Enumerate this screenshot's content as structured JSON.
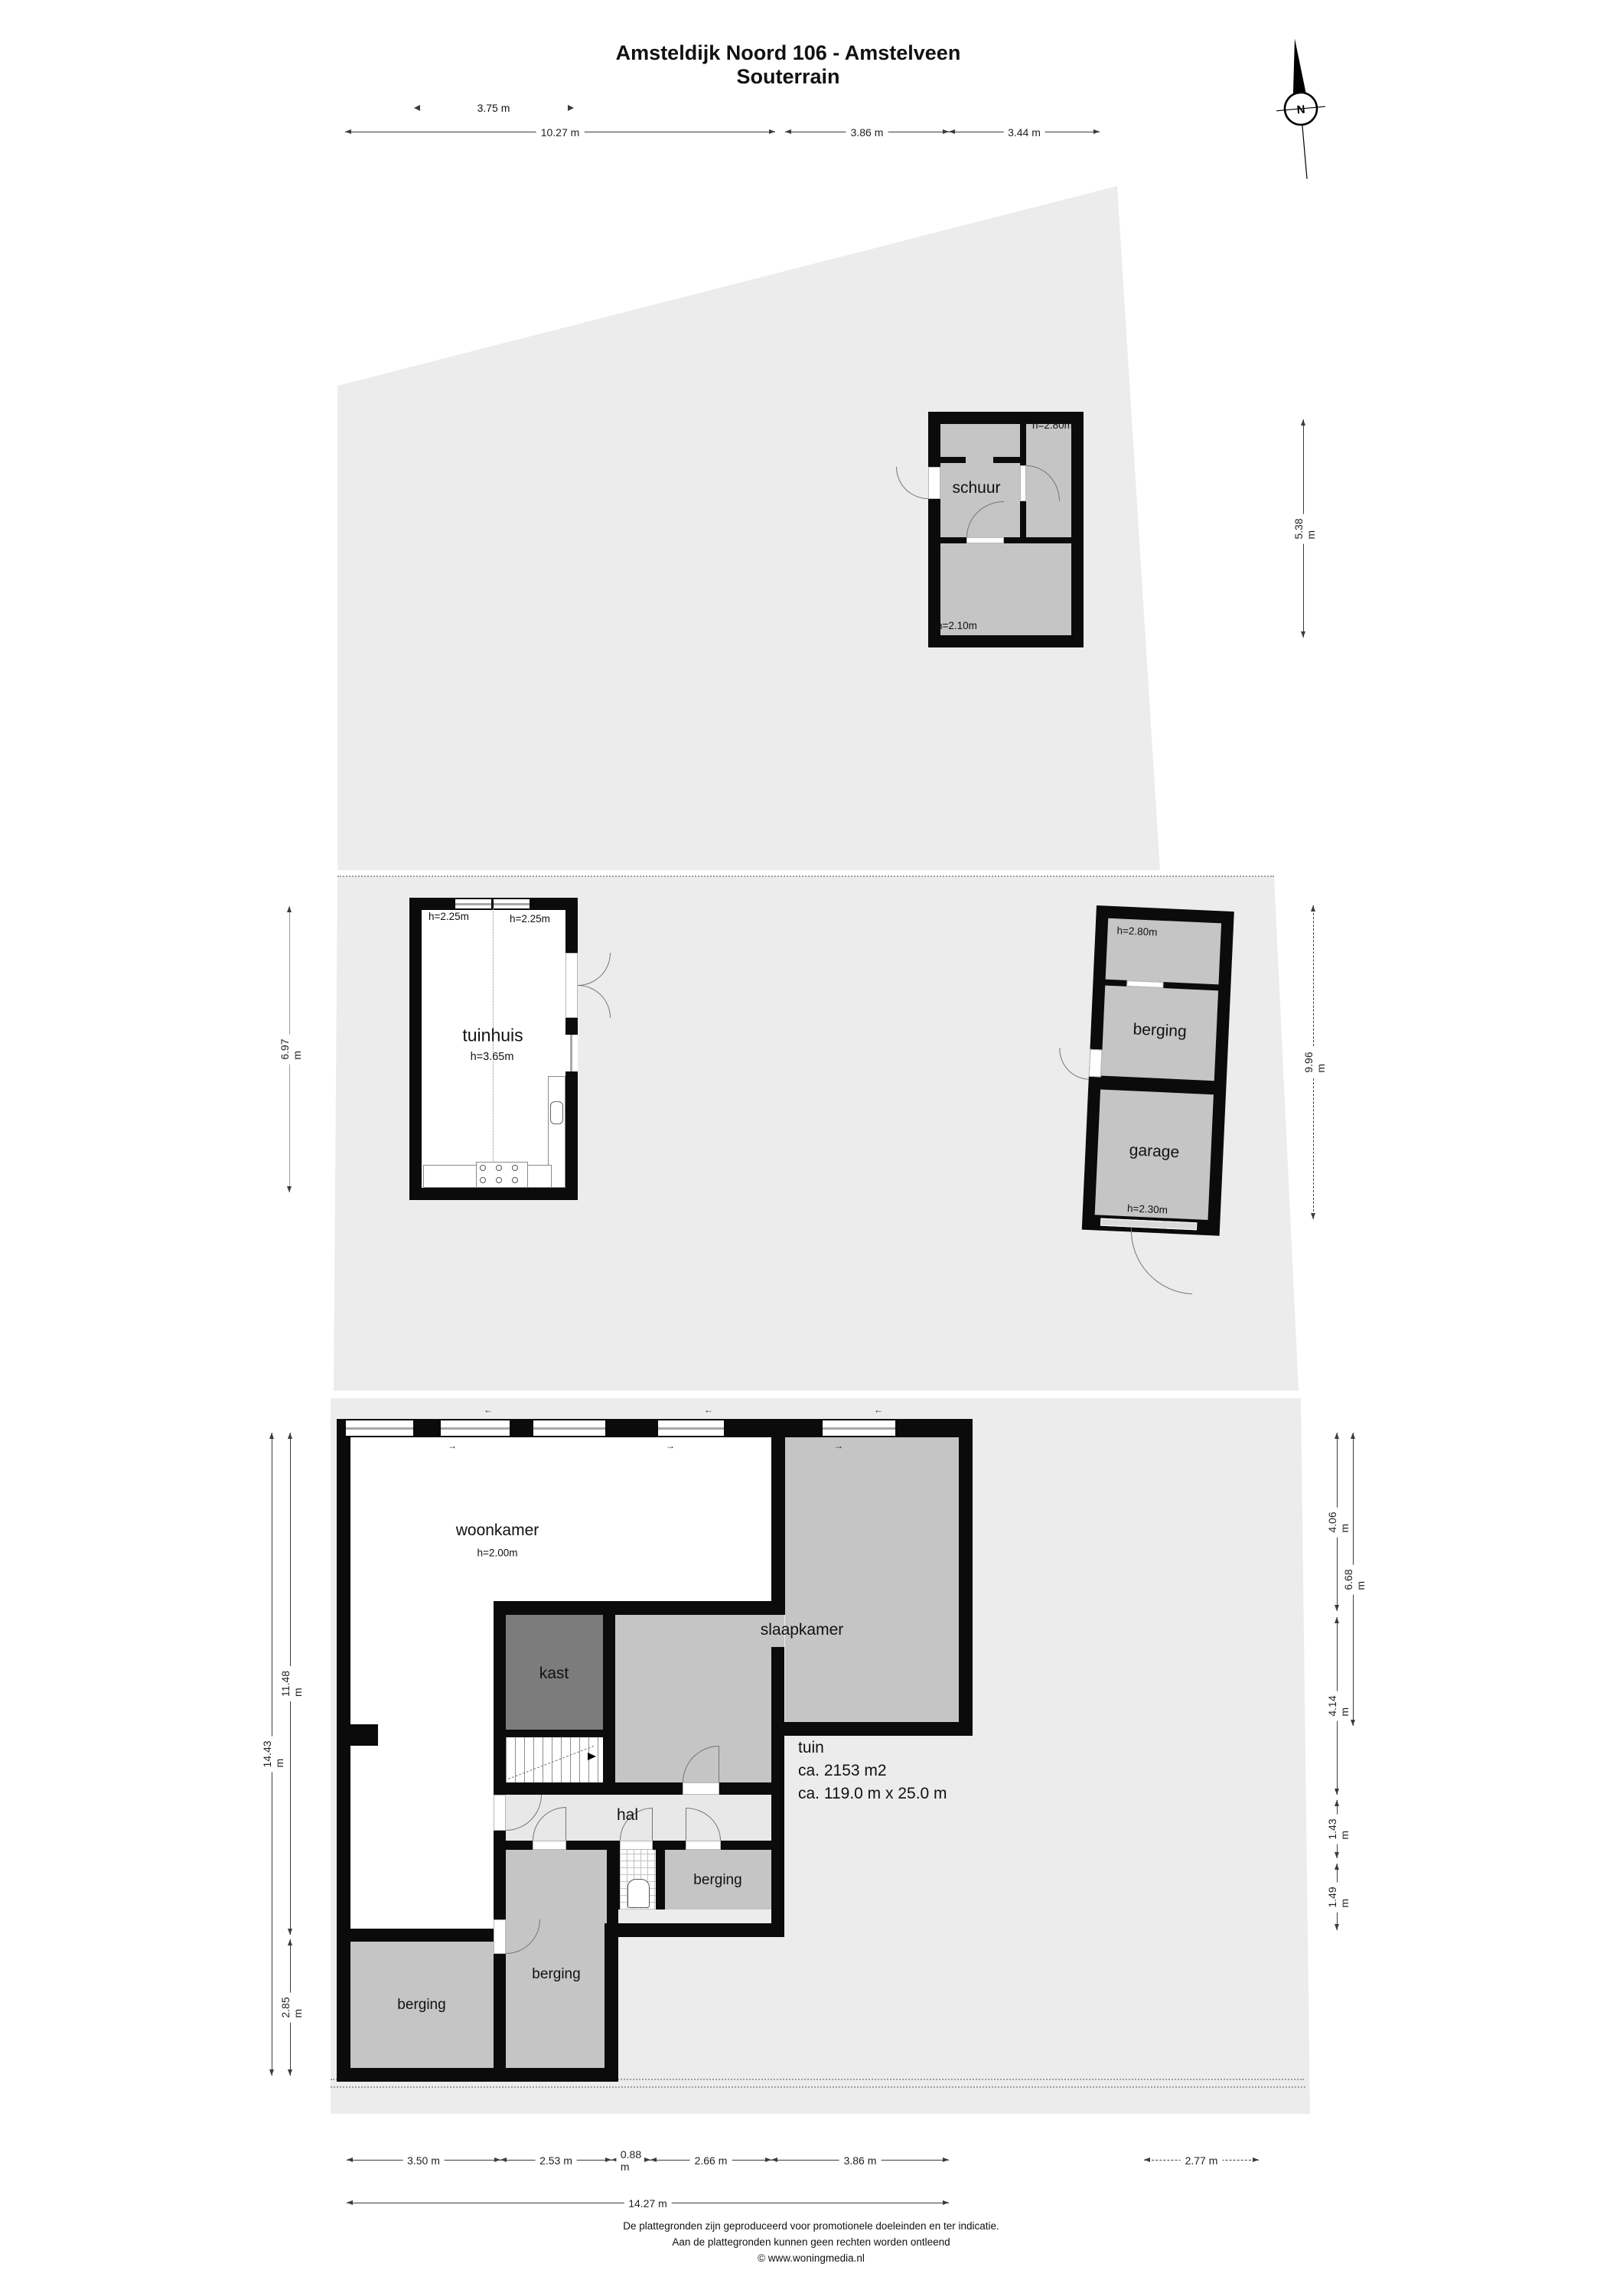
{
  "title": {
    "line1": "Amsteldijk Noord 106 - Amstelveen",
    "line2": "Souterrain"
  },
  "compass": {
    "north_label": "N"
  },
  "rooms": {
    "schuur": {
      "label": "schuur",
      "h_right": "h=2.80m",
      "h_bottom": "h=2.10m"
    },
    "tuinhuis": {
      "label": "tuinhuis",
      "h_center": "h=3.65m",
      "h_left": "h=2.25m",
      "h_right": "h=2.25m"
    },
    "annex": {
      "h_top": "h=2.80m",
      "berging_label": "berging",
      "garage_label": "garage",
      "h_garage": "h=2.30m"
    },
    "woonkamer": {
      "label": "woonkamer",
      "h": "h=2.00m"
    },
    "slaapkamer": {
      "label": "slaapkamer"
    },
    "kast": {
      "label": "kast"
    },
    "hal": {
      "label": "hal"
    },
    "berging_right": {
      "label": "berging"
    },
    "berging_middle": {
      "label": "berging"
    },
    "berging_left": {
      "label": "berging"
    },
    "tuin": {
      "line1": "tuin",
      "line2": "ca. 2153 m2",
      "line3": "ca. 119.0 m x 25.0 m"
    }
  },
  "dimensions": {
    "top_overhang": "3.75 m",
    "top_row": [
      "10.27 m",
      "3.86 m",
      "3.44 m"
    ],
    "schuur_height": "5.38 m",
    "tuinhuis_left": "6.97 m",
    "annex_right": "9.96 m",
    "house_left_total": "14.43 m",
    "house_left_upper": "11.48 m",
    "house_left_lower": "2.85 m",
    "house_right": [
      "4.06 m",
      "6.68 m",
      "4.14 m",
      "1.43 m",
      "1.49 m"
    ],
    "bottom_row": [
      "3.50 m",
      "2.53 m",
      "0.88 m",
      "2.66 m",
      "3.86 m"
    ],
    "bottom_total": "14.27 m",
    "bottom_right": "2.77 m"
  },
  "icons": {
    "vent_left": "←",
    "vent_right": "→"
  },
  "footer": {
    "line1": "De plattegronden zijn geproduceerd voor promotionele doeleinden en ter indicatie.",
    "line2": "Aan de plattegronden kunnen geen rechten worden ontleend",
    "line3": "© www.woningmedia.nl"
  },
  "colors": {
    "plot": "#ececec",
    "room": "#c5c5c5",
    "room_dark": "#7c7c7c",
    "hal": "#e8e8e8",
    "wall": "#0b0b0b"
  }
}
